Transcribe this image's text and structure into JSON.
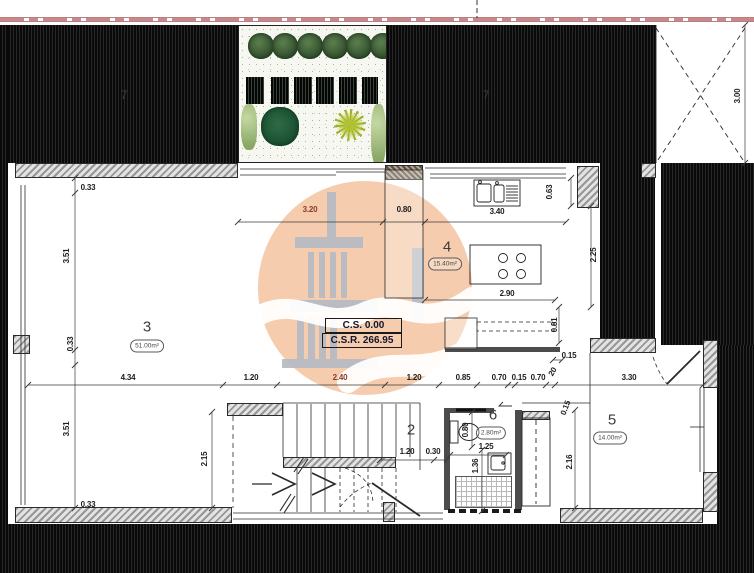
{
  "plan_type": "floor-plan",
  "levels": {
    "cs": "C.S. 0.00",
    "csr": "C.S.R. 266.95"
  },
  "rooms": [
    {
      "number": "3",
      "area": "51.00m²",
      "nx": 147,
      "ny": 327,
      "ax": 147,
      "ay": 346
    },
    {
      "number": "4",
      "area": "15.40m²",
      "nx": 447,
      "ny": 247,
      "ax": 445,
      "ay": 264
    },
    {
      "number": "2",
      "area": "",
      "nx": 411,
      "ny": 430,
      "ax": 0,
      "ay": 0
    },
    {
      "number": "5",
      "area": "14.00m²",
      "nx": 612,
      "ny": 420,
      "ax": 610,
      "ay": 438
    },
    {
      "number": "6",
      "area": "2.80m²",
      "nx": 493,
      "ny": 415,
      "ax": 491,
      "ay": 433
    }
  ],
  "neighbor_plots": [
    {
      "label": "7",
      "x": 124,
      "y": 95
    },
    {
      "label": "7",
      "x": 486,
      "y": 95
    }
  ],
  "dimensions": [
    {
      "t": "3.20",
      "x": 310,
      "y": 210,
      "c": "brown"
    },
    {
      "t": "0.80",
      "x": 404,
      "y": 210
    },
    {
      "t": "3.40",
      "x": 497,
      "y": 212
    },
    {
      "t": "0.63",
      "x": 550,
      "y": 192,
      "r": -90
    },
    {
      "t": "2.25",
      "x": 594,
      "y": 255,
      "r": -90
    },
    {
      "t": "2.90",
      "x": 507,
      "y": 294
    },
    {
      "t": "0.81",
      "x": 555,
      "y": 325,
      "r": -90
    },
    {
      "t": "0.15",
      "x": 569,
      "y": 356
    },
    {
      "t": "3.00",
      "x": 738,
      "y": 96,
      "r": -90
    },
    {
      "t": "4.34",
      "x": 128,
      "y": 378
    },
    {
      "t": "1.20",
      "x": 251,
      "y": 378
    },
    {
      "t": "2.40",
      "x": 340,
      "y": 378,
      "c": "brown"
    },
    {
      "t": "1.20",
      "x": 414,
      "y": 378
    },
    {
      "t": "0.85",
      "x": 463,
      "y": 378
    },
    {
      "t": "0.70",
      "x": 499,
      "y": 378
    },
    {
      "t": "0.15",
      "x": 519,
      "y": 378
    },
    {
      "t": "0.70",
      "x": 538,
      "y": 378
    },
    {
      "t": "20",
      "x": 553,
      "y": 372,
      "r": -60
    },
    {
      "t": "3.30",
      "x": 629,
      "y": 378
    },
    {
      "t": "0.15",
      "x": 566,
      "y": 408,
      "r": -70
    },
    {
      "t": "0.33",
      "x": 88,
      "y": 188
    },
    {
      "t": "3.51",
      "x": 67,
      "y": 256,
      "r": -90
    },
    {
      "t": "0.33",
      "x": 71,
      "y": 344,
      "r": -90
    },
    {
      "t": "3.51",
      "x": 67,
      "y": 429,
      "r": -90
    },
    {
      "t": "0.33",
      "x": 88,
      "y": 505
    },
    {
      "t": "2.15",
      "x": 205,
      "y": 459,
      "r": -90
    },
    {
      "t": "2.16",
      "x": 570,
      "y": 462,
      "r": -90
    },
    {
      "t": "1.20",
      "x": 407,
      "y": 452
    },
    {
      "t": "0.30",
      "x": 433,
      "y": 452
    },
    {
      "t": "0.80",
      "x": 466,
      "y": 430,
      "r": -90
    },
    {
      "t": "1.25",
      "x": 486,
      "y": 447
    },
    {
      "t": "1.36",
      "x": 476,
      "y": 466,
      "r": -90
    }
  ],
  "colors": {
    "boundary": "#c9898b",
    "watermark": "#f3c29c",
    "dim_accent": "#8a3c28"
  }
}
